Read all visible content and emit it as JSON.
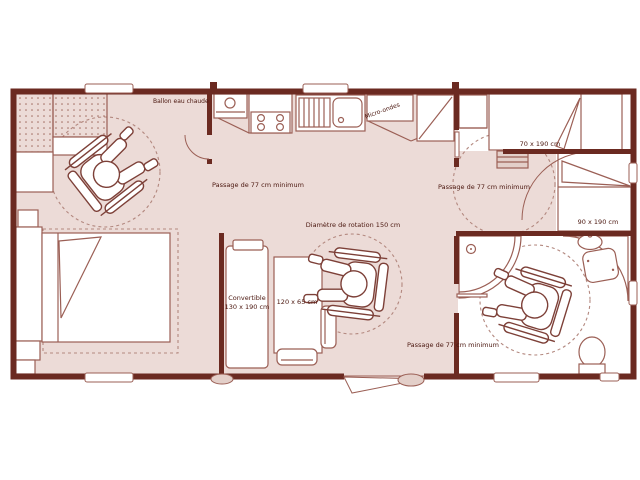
{
  "plan": {
    "labels": {
      "water_heater": "Ballon eau chaude",
      "microwave": "Micro-ondes",
      "passage_1": "Passage de 77 cm minimum",
      "passage_2": "Passage de 77 cm minimum",
      "passage_3": "Passage de 77 cm minimum",
      "rotation_diameter": "Diamètre de rotation 150 cm",
      "bed_single_small": "70 x 190 cm",
      "bed_single_large": "90 x 190 cm",
      "convertible_line1": "Convertible",
      "convertible_line2": "130 x 190 cm",
      "table": "120 x 65 cm"
    },
    "colors": {
      "wall": "#6b2a21",
      "floor": "#ecdbd7",
      "outline": "#9b5f55",
      "dashed": "#b3887f",
      "text": "#4a160e",
      "room_fill": "#ffffff"
    }
  }
}
